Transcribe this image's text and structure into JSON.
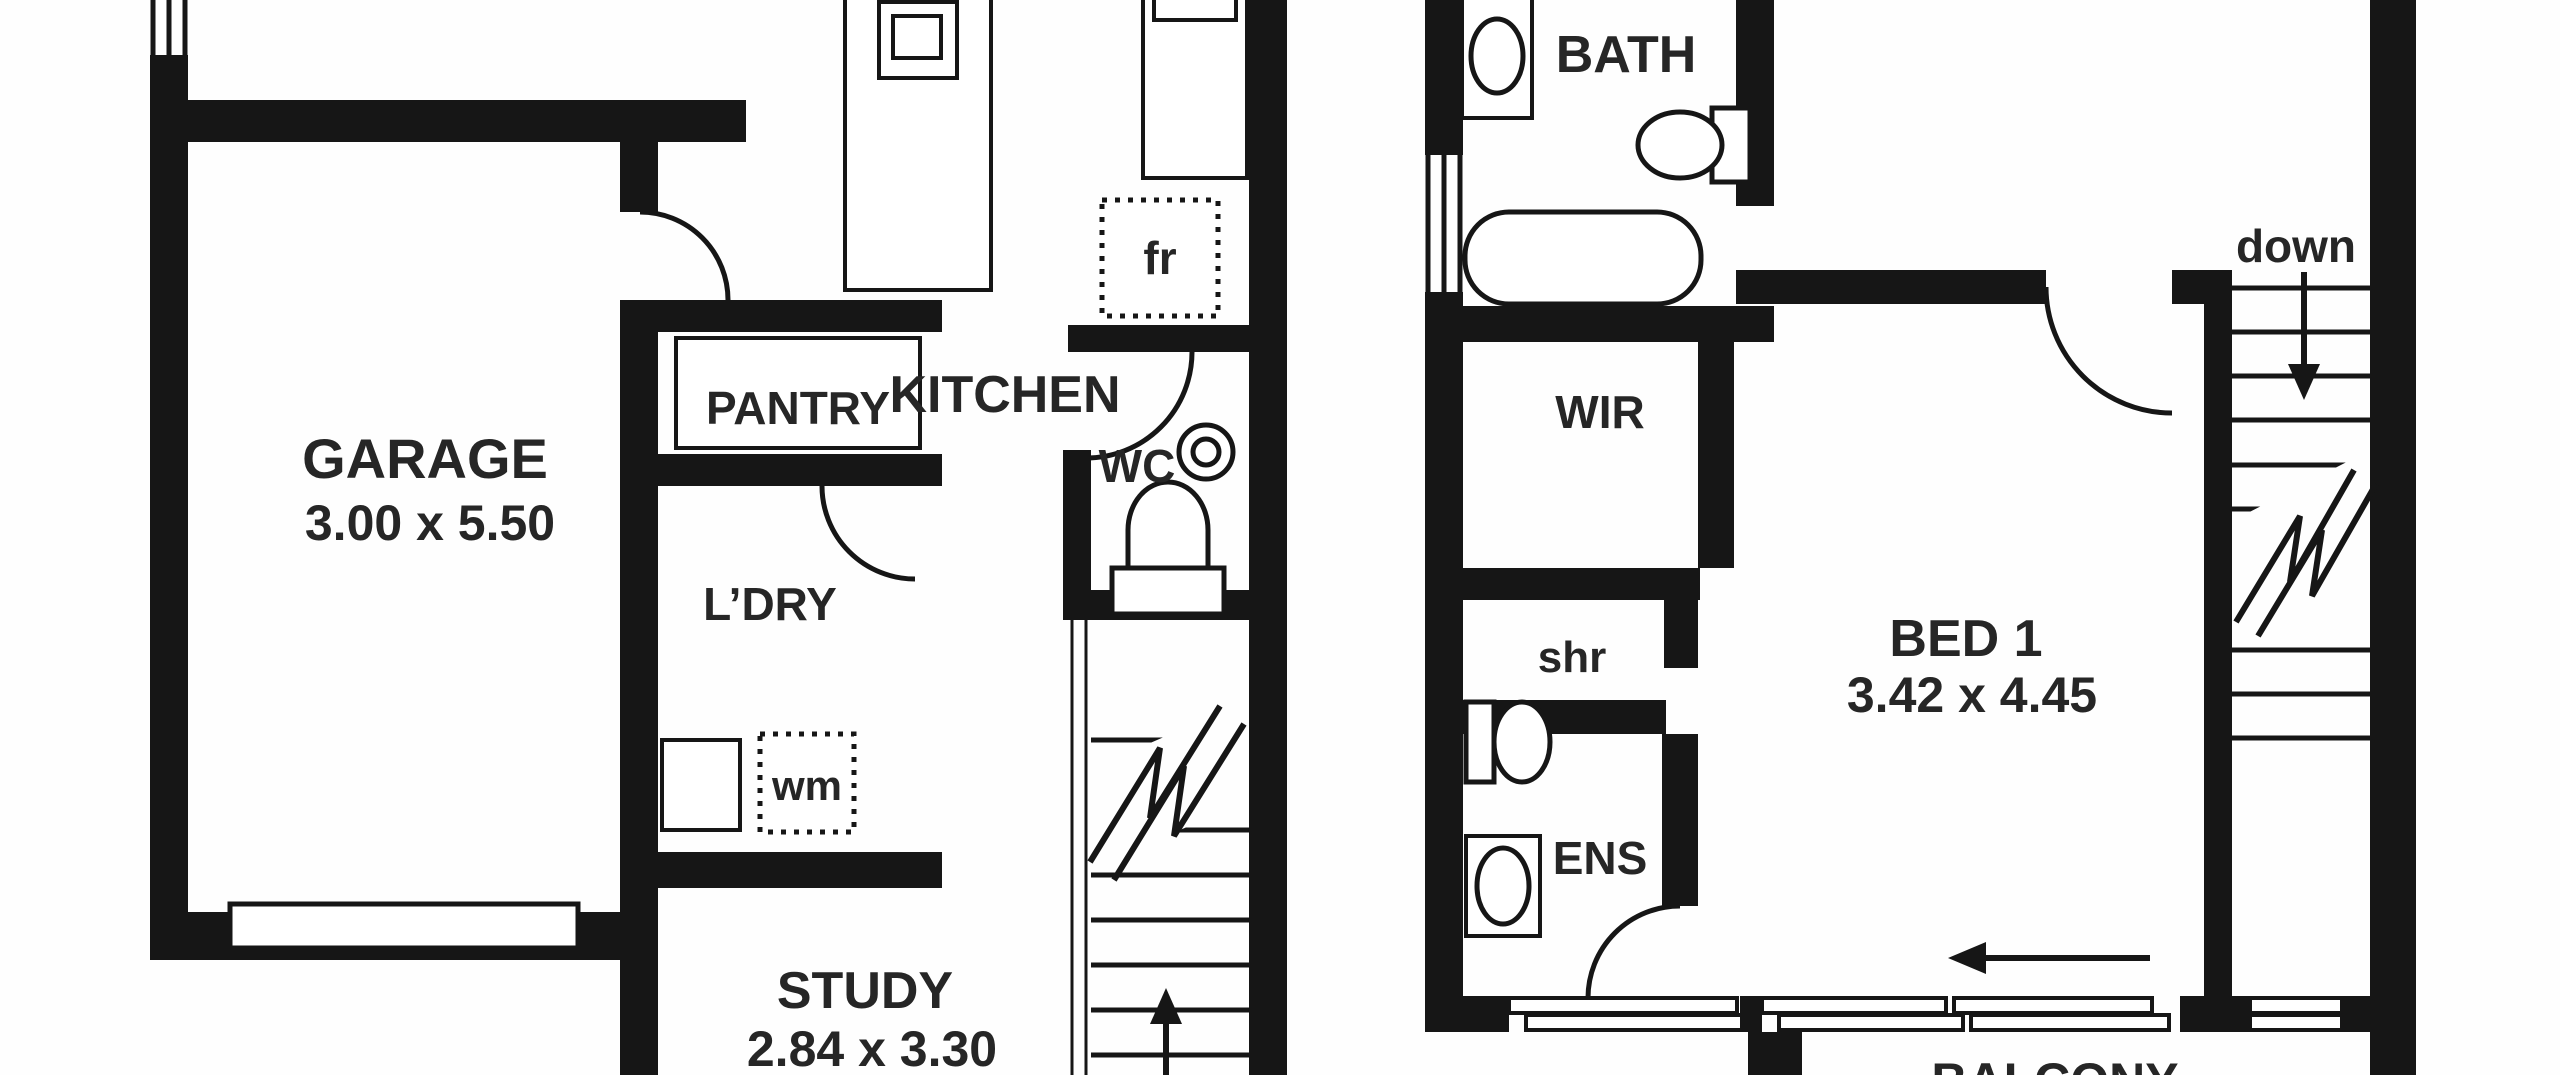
{
  "title": "Two-storey townhouse floor plan",
  "floors": {
    "ground": {
      "rooms": {
        "garage": {
          "label": "GARAGE",
          "dims": "3.00 x 5.50"
        },
        "pantry": {
          "label": "PANTRY"
        },
        "laundry": {
          "label": "L’DRY"
        },
        "kitchen": {
          "label": "KITCHEN"
        },
        "wc": {
          "label": "WC"
        },
        "study": {
          "label": "STUDY",
          "dims": "2.84 x 3.30"
        }
      },
      "fixtures": {
        "fridge": "fr",
        "washing_machine": "wm"
      }
    },
    "upper": {
      "rooms": {
        "bath": {
          "label": "BATH"
        },
        "wir": {
          "label": "WIR"
        },
        "shower": {
          "label": "shr"
        },
        "ensuite": {
          "label": "ENS"
        },
        "bed1": {
          "label": "BED 1",
          "dims": "3.42 x 4.45"
        },
        "balcony": {
          "label": "BALCONY"
        }
      },
      "stairs": {
        "down_label": "down"
      }
    }
  },
  "colors": {
    "wall": "#161616",
    "text": "#262626",
    "background": "#fefefe"
  }
}
